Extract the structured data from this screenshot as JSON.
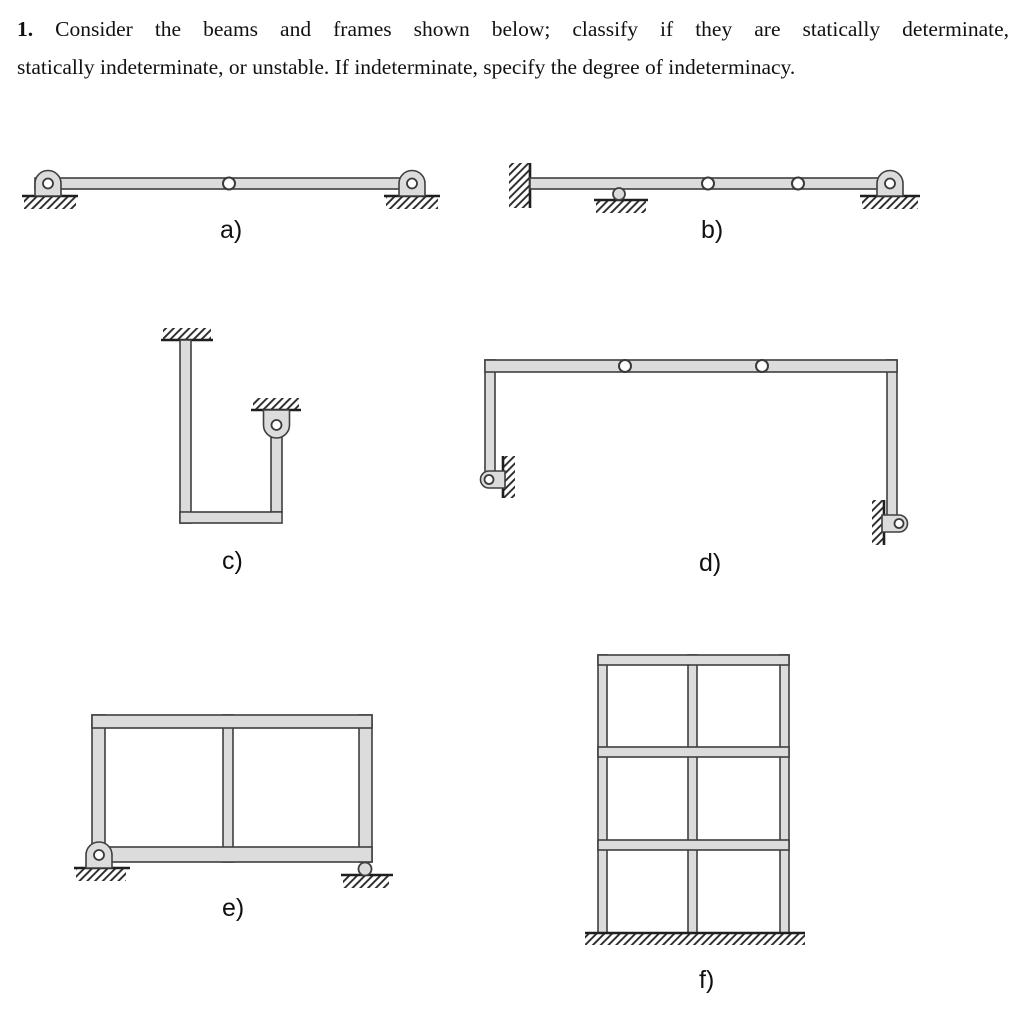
{
  "problem": {
    "number": "1.",
    "line1": "Consider the beams and frames shown below; classify if they are statically determinate,",
    "line2": "statically indeterminate, or unstable. If indeterminate, specify the degree of indeterminacy."
  },
  "figures": [
    {
      "label": "a)",
      "description": "beam with pin supports at both ends and one internal hinge at midspan"
    },
    {
      "label": "b)",
      "description": "beam with fixed wall support at left, one roller support, two internal hinges, pin support at right end"
    },
    {
      "label": "c)",
      "description": "U-shaped frame fixed to ceiling at left member, pin hanger support at top of right member"
    },
    {
      "label": "d)",
      "description": "portal frame with two internal hinges in top beam and wall pin supports at both column bases"
    },
    {
      "label": "e)",
      "description": "two-bay closed frame with pin support at bottom left and roller support at bottom right"
    },
    {
      "label": "f)",
      "description": "two-bay three-story frame with columns fixed into the ground"
    }
  ],
  "colors": {
    "member_fill": "#dcdcdc",
    "outline": "#3f3f3f",
    "hatch": "#2a2a2a",
    "background": "#ffffff"
  }
}
